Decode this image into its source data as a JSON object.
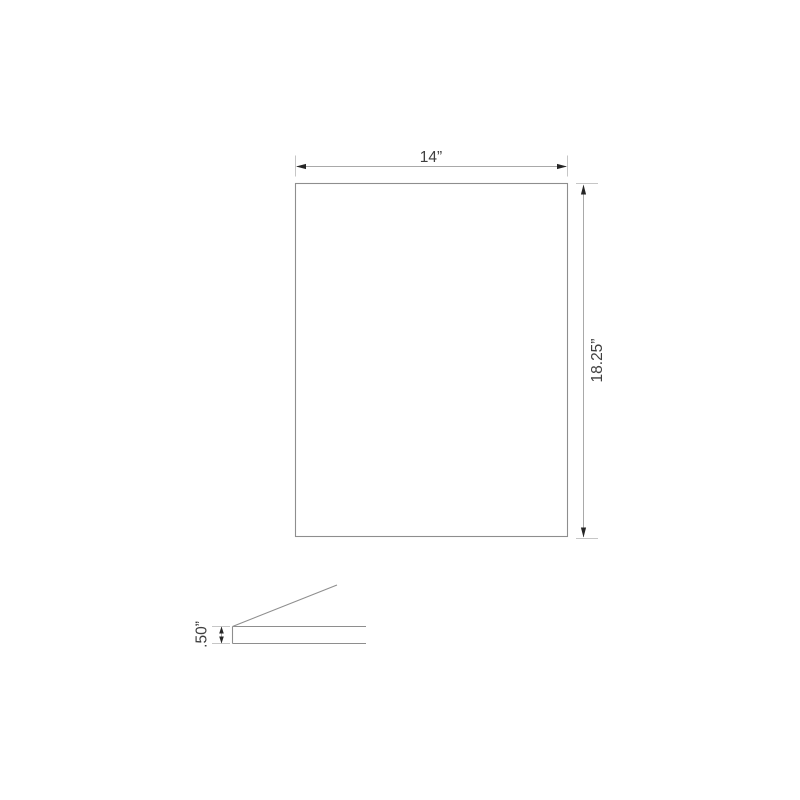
{
  "drawing": {
    "front_view": {
      "width_label": "14”",
      "height_label": "18.25”"
    },
    "side_view": {
      "thickness_label": ".50”"
    },
    "colors": {
      "background": "#ffffff",
      "object_line": "#8e8e8e",
      "dimension_line": "#a9a9a9",
      "extension_line": "#c6c6c6",
      "arrow": "#262626",
      "text": "#3f3f3f"
    }
  }
}
